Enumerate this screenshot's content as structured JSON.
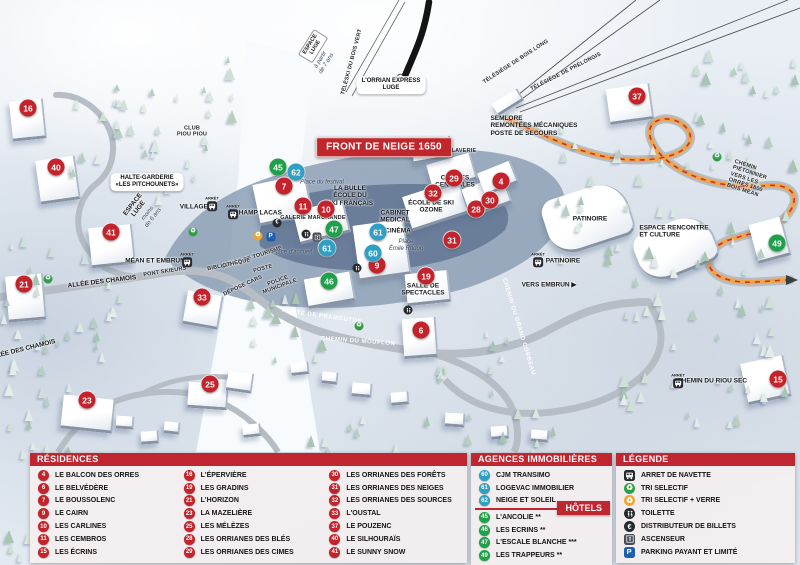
{
  "map": {
    "banner": "FRONT DE NEIGE 1650",
    "labels": [
      {
        "t": "ESPACE\nLUGE",
        "x": 313,
        "y": 46,
        "r": -58,
        "s": "sign"
      },
      {
        "t": "à partir\nde 7 ans",
        "x": 324,
        "y": 62,
        "r": -58,
        "s": "it"
      },
      {
        "t": "TÉLÉSKI DU BOIS VERT",
        "x": 352,
        "y": 62,
        "r": -75,
        "s": "t"
      },
      {
        "t": "L'ORRIAN EXPRESS\nLUGE",
        "x": 391,
        "y": 85,
        "r": 0,
        "s": "p"
      },
      {
        "t": "TÉLÉSIÈGE DE BOIS LONG",
        "x": 516,
        "y": 62,
        "r": -33,
        "s": "t"
      },
      {
        "t": "TÉLÉSIÈGE DE PRÉLONGIS",
        "x": 566,
        "y": 72,
        "r": -27,
        "s": "t"
      },
      {
        "t": "SEMLORE\nREMONTÉES MÉCANIQUES\nPOSTE DE SECOURS",
        "x": 534,
        "y": 126,
        "r": 0,
        "s": "b",
        "a": "l"
      },
      {
        "t": "CLUB\nPIOU PIOU",
        "x": 192,
        "y": 132,
        "r": 0,
        "s": "t"
      },
      {
        "t": "HALTE-GARDERIE\n«LES PITCHOUNETS»",
        "x": 147,
        "y": 182,
        "r": 0,
        "s": "p"
      },
      {
        "t": "ESPACE\nLUGE",
        "x": 136,
        "y": 207,
        "r": -52,
        "s": "b"
      },
      {
        "t": "moins\nde 6 ans",
        "x": 151,
        "y": 216,
        "r": -52,
        "s": "it"
      },
      {
        "t": "VILLAGES",
        "x": 196,
        "y": 207,
        "r": 0,
        "s": "b"
      },
      {
        "t": "CHAMP LACAS",
        "x": 258,
        "y": 213,
        "r": 0,
        "s": "b"
      },
      {
        "t": "MÉAN ET EMBRUN",
        "x": 155,
        "y": 261,
        "r": 0,
        "s": "b"
      },
      {
        "t": "ALLÉE DES CHAMOIS",
        "x": 102,
        "y": 282,
        "r": -7,
        "s": "b"
      },
      {
        "t": "ALLÉE DES CHAMOIS",
        "x": 22,
        "y": 350,
        "r": -14,
        "s": "b"
      },
      {
        "t": "PONT SKIEURS",
        "x": 165,
        "y": 272,
        "r": -9,
        "s": "t"
      },
      {
        "t": "OFFICE DE TOURISME",
        "x": 252,
        "y": 258,
        "r": -18,
        "s": "t"
      },
      {
        "t": "BIBLIOTHÈQUE",
        "x": 229,
        "y": 265,
        "r": -12,
        "s": "t"
      },
      {
        "t": "POSTE",
        "x": 263,
        "y": 269,
        "r": -15,
        "s": "t"
      },
      {
        "t": "DÉPOSE CARS",
        "x": 243,
        "y": 286,
        "r": -25,
        "s": "t"
      },
      {
        "t": "POLICE\nMUNICIPALE",
        "x": 279,
        "y": 284,
        "r": -20,
        "s": "t"
      },
      {
        "t": "Place d'accueil",
        "x": 292,
        "y": 253,
        "r": 0,
        "s": "it"
      },
      {
        "t": "Place du festival",
        "x": 322,
        "y": 183,
        "r": 0,
        "s": "it"
      },
      {
        "t": "LA BULLE\nÉCOLE DU\nSKI FRANÇAIS",
        "x": 350,
        "y": 196,
        "r": 0,
        "s": "b"
      },
      {
        "t": "GALERIE MARCHANDE",
        "x": 313,
        "y": 218,
        "r": 0,
        "s": "t"
      },
      {
        "t": "CAISSES\nCENTRALES",
        "x": 455,
        "y": 182,
        "r": 0,
        "s": "b"
      },
      {
        "t": "LAVERIE",
        "x": 464,
        "y": 151,
        "r": 0,
        "s": "t"
      },
      {
        "t": "ÉCOLE DE SKI\nOZONE",
        "x": 431,
        "y": 207,
        "r": 0,
        "s": "b"
      },
      {
        "t": "CABINET\nMÉDICAL",
        "x": 395,
        "y": 217,
        "r": 0,
        "s": "b"
      },
      {
        "t": "CINÉMA",
        "x": 398,
        "y": 231,
        "r": 0,
        "s": "b"
      },
      {
        "t": "Place\nÉmile Rodon",
        "x": 406,
        "y": 246,
        "r": 0,
        "s": "it"
      },
      {
        "t": "SALLE DE\nSPECTACLES",
        "x": 423,
        "y": 290,
        "r": 0,
        "s": "b"
      },
      {
        "t": "ROUTE DE PRAMOUTON",
        "x": 322,
        "y": 317,
        "r": 8,
        "s": "rd"
      },
      {
        "t": "CHEMIN DU MOUFLON",
        "x": 358,
        "y": 342,
        "r": 4,
        "s": "rd"
      },
      {
        "t": "CHEMIN DU GRAND CORBEAU",
        "x": 518,
        "y": 327,
        "r": 73,
        "s": "rd"
      },
      {
        "t": "VERS EMBRUN ▶",
        "x": 549,
        "y": 285,
        "r": 0,
        "s": "b"
      },
      {
        "t": "PATINOIRE",
        "x": 590,
        "y": 219,
        "r": 0,
        "s": "b"
      },
      {
        "t": "PATINOIRE",
        "x": 563,
        "y": 261,
        "r": 0,
        "s": "b"
      },
      {
        "t": "ESPACE RENCONTRE\nET CULTURE",
        "x": 674,
        "y": 232,
        "r": 0,
        "s": "b",
        "a": "l"
      },
      {
        "t": "CHEMIN PIÉTONNIER\nVERS LES ORRES 1800\nBOIS MÉAN",
        "x": 753,
        "y": 181,
        "r": 18,
        "s": "t",
        "a": "l"
      },
      {
        "t": "CHEMIN DU RIOU SEC",
        "x": 712,
        "y": 381,
        "r": 0,
        "s": "b"
      }
    ],
    "markers": [
      {
        "n": "16",
        "x": 28,
        "y": 108,
        "c": "red"
      },
      {
        "n": "40",
        "x": 56,
        "y": 167,
        "c": "red"
      },
      {
        "n": "41",
        "x": 111,
        "y": 232,
        "c": "red"
      },
      {
        "n": "21",
        "x": 24,
        "y": 284,
        "c": "red"
      },
      {
        "n": "23",
        "x": 87,
        "y": 400,
        "c": "red"
      },
      {
        "n": "25",
        "x": 210,
        "y": 384,
        "c": "red"
      },
      {
        "n": "33",
        "x": 202,
        "y": 297,
        "c": "red"
      },
      {
        "n": "7",
        "x": 284,
        "y": 186,
        "c": "red"
      },
      {
        "n": "11",
        "x": 303,
        "y": 206,
        "c": "red"
      },
      {
        "n": "10",
        "x": 326,
        "y": 209,
        "c": "red"
      },
      {
        "n": "9",
        "x": 377,
        "y": 265,
        "c": "red"
      },
      {
        "n": "19",
        "x": 426,
        "y": 276,
        "c": "red"
      },
      {
        "n": "6",
        "x": 421,
        "y": 330,
        "c": "red"
      },
      {
        "n": "31",
        "x": 452,
        "y": 240,
        "c": "red"
      },
      {
        "n": "28",
        "x": 476,
        "y": 209,
        "c": "red"
      },
      {
        "n": "32",
        "x": 433,
        "y": 193,
        "c": "red"
      },
      {
        "n": "29",
        "x": 454,
        "y": 178,
        "c": "red"
      },
      {
        "n": "30",
        "x": 490,
        "y": 200,
        "c": "red"
      },
      {
        "n": "4",
        "x": 501,
        "y": 181,
        "c": "red"
      },
      {
        "n": "37",
        "x": 637,
        "y": 96,
        "c": "red"
      },
      {
        "n": "15",
        "x": 778,
        "y": 379,
        "c": "red"
      },
      {
        "n": "45",
        "x": 278,
        "y": 167,
        "c": "green"
      },
      {
        "n": "47",
        "x": 334,
        "y": 229,
        "c": "green"
      },
      {
        "n": "46",
        "x": 329,
        "y": 281,
        "c": "green"
      },
      {
        "n": "49",
        "x": 777,
        "y": 243,
        "c": "green"
      },
      {
        "n": "62",
        "x": 296,
        "y": 172,
        "c": "blue"
      },
      {
        "n": "61",
        "x": 327,
        "y": 248,
        "c": "blue"
      },
      {
        "n": "61",
        "x": 378,
        "y": 232,
        "c": "blue"
      },
      {
        "n": "60",
        "x": 373,
        "y": 253,
        "c": "blue"
      }
    ],
    "bus_stops": [
      {
        "x": 212,
        "y": 203
      },
      {
        "x": 233,
        "y": 211
      },
      {
        "x": 187,
        "y": 259
      },
      {
        "x": 538,
        "y": 259
      },
      {
        "x": 678,
        "y": 380
      }
    ],
    "icons": [
      {
        "t": "recycle",
        "x": 193,
        "y": 232
      },
      {
        "t": "recycle",
        "x": 48,
        "y": 279
      },
      {
        "t": "recycle",
        "x": 717,
        "y": 157
      },
      {
        "t": "recycle",
        "x": 359,
        "y": 326
      },
      {
        "t": "verre",
        "x": 258,
        "y": 236
      },
      {
        "t": "park",
        "x": 271,
        "y": 237
      },
      {
        "t": "euro",
        "x": 277,
        "y": 223
      },
      {
        "t": "wc",
        "x": 306,
        "y": 234
      },
      {
        "t": "asc",
        "x": 317,
        "y": 237
      },
      {
        "t": "wc",
        "x": 357,
        "y": 268
      },
      {
        "t": "wc",
        "x": 408,
        "y": 310
      }
    ],
    "bus_stop_micro_label": "ARRÊT"
  },
  "panels": {
    "residences": {
      "title": "RÉSIDENCES",
      "items": [
        {
          "n": "4",
          "label": "LE BALCON DES ORRES"
        },
        {
          "n": "6",
          "label": "LE BELVÉDÈRE"
        },
        {
          "n": "7",
          "label": "LE BOUSSOLENC"
        },
        {
          "n": "9",
          "label": "LE CAIRN"
        },
        {
          "n": "10",
          "label": "LES CARLINES"
        },
        {
          "n": "11",
          "label": "LES CEMBROS"
        },
        {
          "n": "15",
          "label": "LES ÉCRINS"
        },
        {
          "n": "16",
          "label": "L'ÉPERVIÈRE"
        },
        {
          "n": "19",
          "label": "LES GRADINS"
        },
        {
          "n": "21",
          "label": "L'HORIZON"
        },
        {
          "n": "23",
          "label": "LA MAZELIÈRE"
        },
        {
          "n": "25",
          "label": "LES MÉLÈZES"
        },
        {
          "n": "28",
          "label": "LES ORRIANES DES BLÉS"
        },
        {
          "n": "29",
          "label": "LES ORRIANES DES CIMES"
        },
        {
          "n": "30",
          "label": "LES ORRIANES DES FORÊTS"
        },
        {
          "n": "31",
          "label": "LES ORRIANES DES NEIGES"
        },
        {
          "n": "32",
          "label": "LES ORRIANES DES SOURCES"
        },
        {
          "n": "33",
          "label": "L'OUSTAL"
        },
        {
          "n": "37",
          "label": "LE POUZENC"
        },
        {
          "n": "40",
          "label": "LE SILHOURAÏS"
        },
        {
          "n": "41",
          "label": "LE SUNNY SNOW"
        }
      ]
    },
    "agences": {
      "title": "AGENCES IMMOBILIÈRES",
      "items": [
        {
          "n": "60",
          "label": "CJM TRANSIMO"
        },
        {
          "n": "61",
          "label": "LOGEVAC IMMOBILIER"
        },
        {
          "n": "62",
          "label": "NEIGE ET SOLEIL"
        }
      ]
    },
    "hotels": {
      "title": "HÔTELS",
      "items": [
        {
          "n": "45",
          "label": "L'ANCOLIE **"
        },
        {
          "n": "46",
          "label": "LES ECRINS **"
        },
        {
          "n": "47",
          "label": "L'ESCALE BLANCHE ***"
        },
        {
          "n": "49",
          "label": "LES TRAPPEURS **"
        }
      ]
    },
    "legende": {
      "title": "LÉGENDE",
      "items": [
        {
          "icon": "bus",
          "label": "ARRET DE NAVETTE"
        },
        {
          "icon": "recycle",
          "label": "TRI SELECTIF"
        },
        {
          "icon": "verre",
          "label": "TRI SELECTIF + VERRE"
        },
        {
          "icon": "wc",
          "label": "TOILETTE"
        },
        {
          "icon": "euro",
          "label": "DISTRIBUTEUR DE BILLETS"
        },
        {
          "icon": "asc",
          "label": "ASCENSEUR"
        },
        {
          "icon": "park",
          "label": "PARKING PAYANT ET LIMITÉ"
        }
      ]
    }
  },
  "colors": {
    "header_red": "#bf2630",
    "banner_red": "#c0272d",
    "marker_red": "#c4232b",
    "marker_green": "#1fa04a",
    "marker_blue": "#2f9fc4",
    "recycle_green": "#2f9e44",
    "verre_orange": "#f0a432",
    "parking_blue": "#1d5fae",
    "dark_icon": "#26292e",
    "elevator_gray": "#4a4f57",
    "path_orange": "#f0a448"
  }
}
